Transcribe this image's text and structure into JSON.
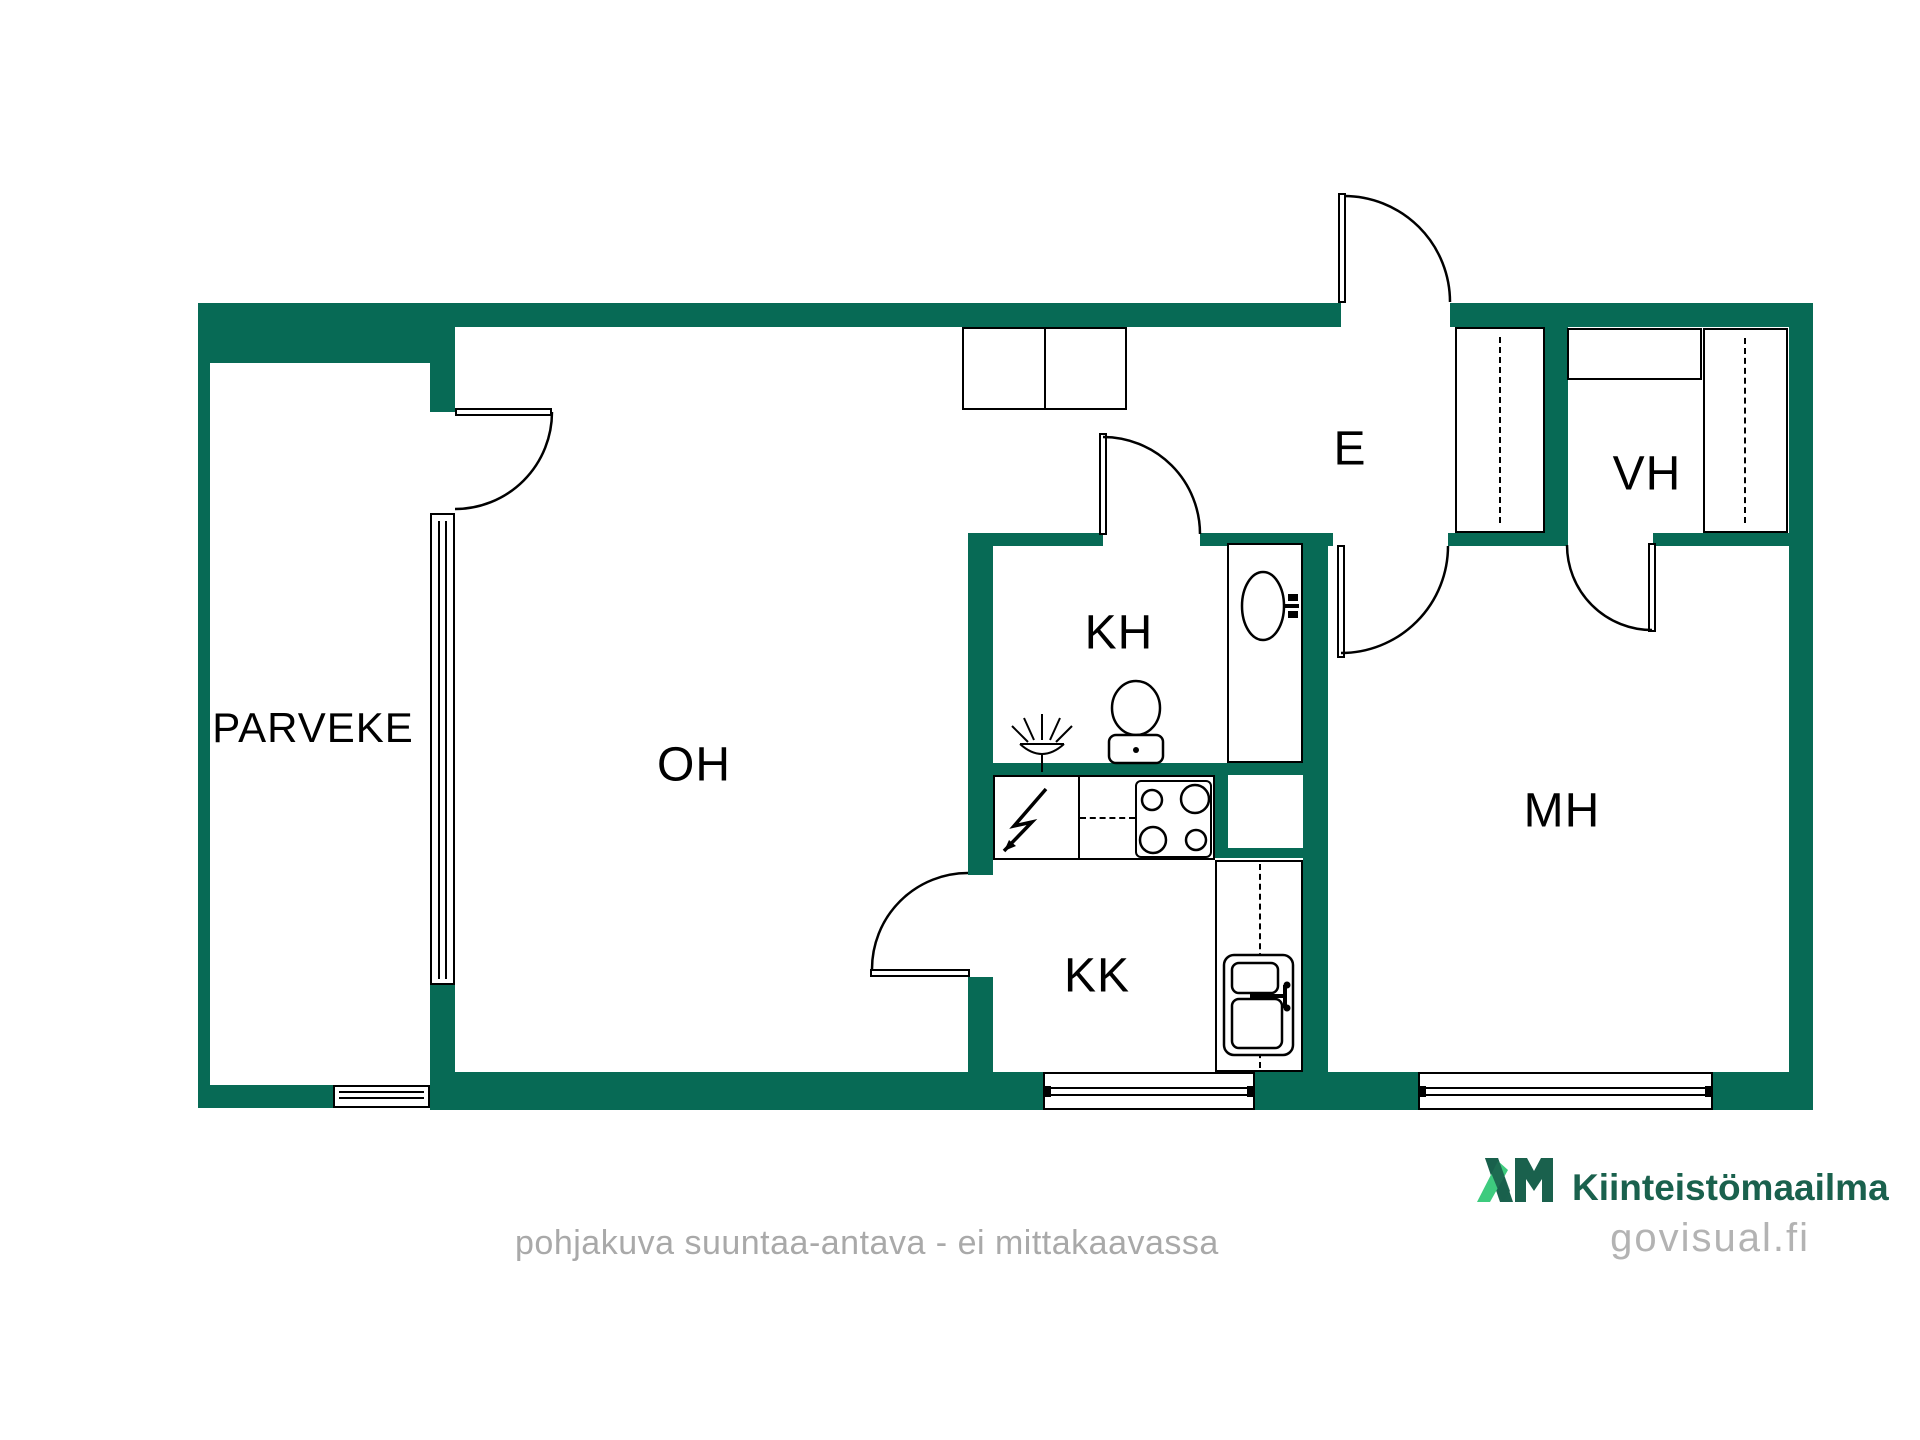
{
  "floorplan": {
    "rooms": {
      "parveke": "PARVEKE",
      "oh": "OH",
      "kh": "KH",
      "kk": "KK",
      "e": "E",
      "vh": "VH",
      "mh": "MH"
    },
    "colors": {
      "wall": "#076a55",
      "line": "#000000"
    }
  },
  "footer": {
    "disclaimer": "pohjakuva suuntaa-antava - ei mittakaavassa"
  },
  "branding": {
    "logo_mark": "KM",
    "company": "Kiinteistömaailma",
    "website": "govisual.fi",
    "colors": {
      "dark_green": "#1a614d",
      "light_green": "#3ecb7e",
      "gray": "#b3b3b3"
    }
  }
}
